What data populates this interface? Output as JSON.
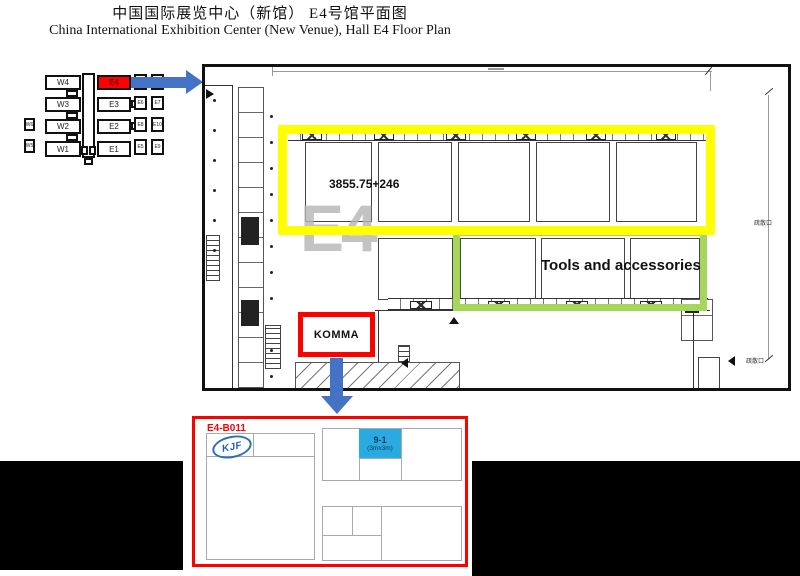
{
  "header": {
    "title_zh": "中国国际展览中心（新馆）  E4号馆平面图",
    "title_en": "China International Exhibition Center (New Venue),  Hall E4 Floor Plan"
  },
  "minimap": {
    "halls_left": [
      "W4",
      "W3",
      "W2",
      "W1"
    ],
    "hall_highlight": "E4",
    "halls_right": [
      "E3",
      "E2",
      "E1"
    ],
    "small_left": [
      "W6",
      "W5"
    ],
    "small_right_a": [
      "",
      "E6",
      "E8",
      "E5"
    ],
    "small_right_b": [
      "",
      "E7",
      "E10",
      "E9"
    ]
  },
  "plan": {
    "area_label": "3855.75+246",
    "watermark": "E4",
    "green_zone_label": "Tools and accessories",
    "highlight_box_label": "KOMMA",
    "exit_label_top": "疏散口",
    "exit_label_bottom": "疏散口"
  },
  "detail": {
    "booth_id": "E4-B011",
    "logo_text": "KJF",
    "booth_number": "9-1",
    "booth_size": "(3mx3m)"
  },
  "colors": {
    "highlight_yellow": "#FFFF00",
    "highlight_green": "#A8D65C",
    "highlight_red": "#FF0000",
    "arrow_blue": "#4472C4",
    "booth_blue": "#29ABE2"
  }
}
